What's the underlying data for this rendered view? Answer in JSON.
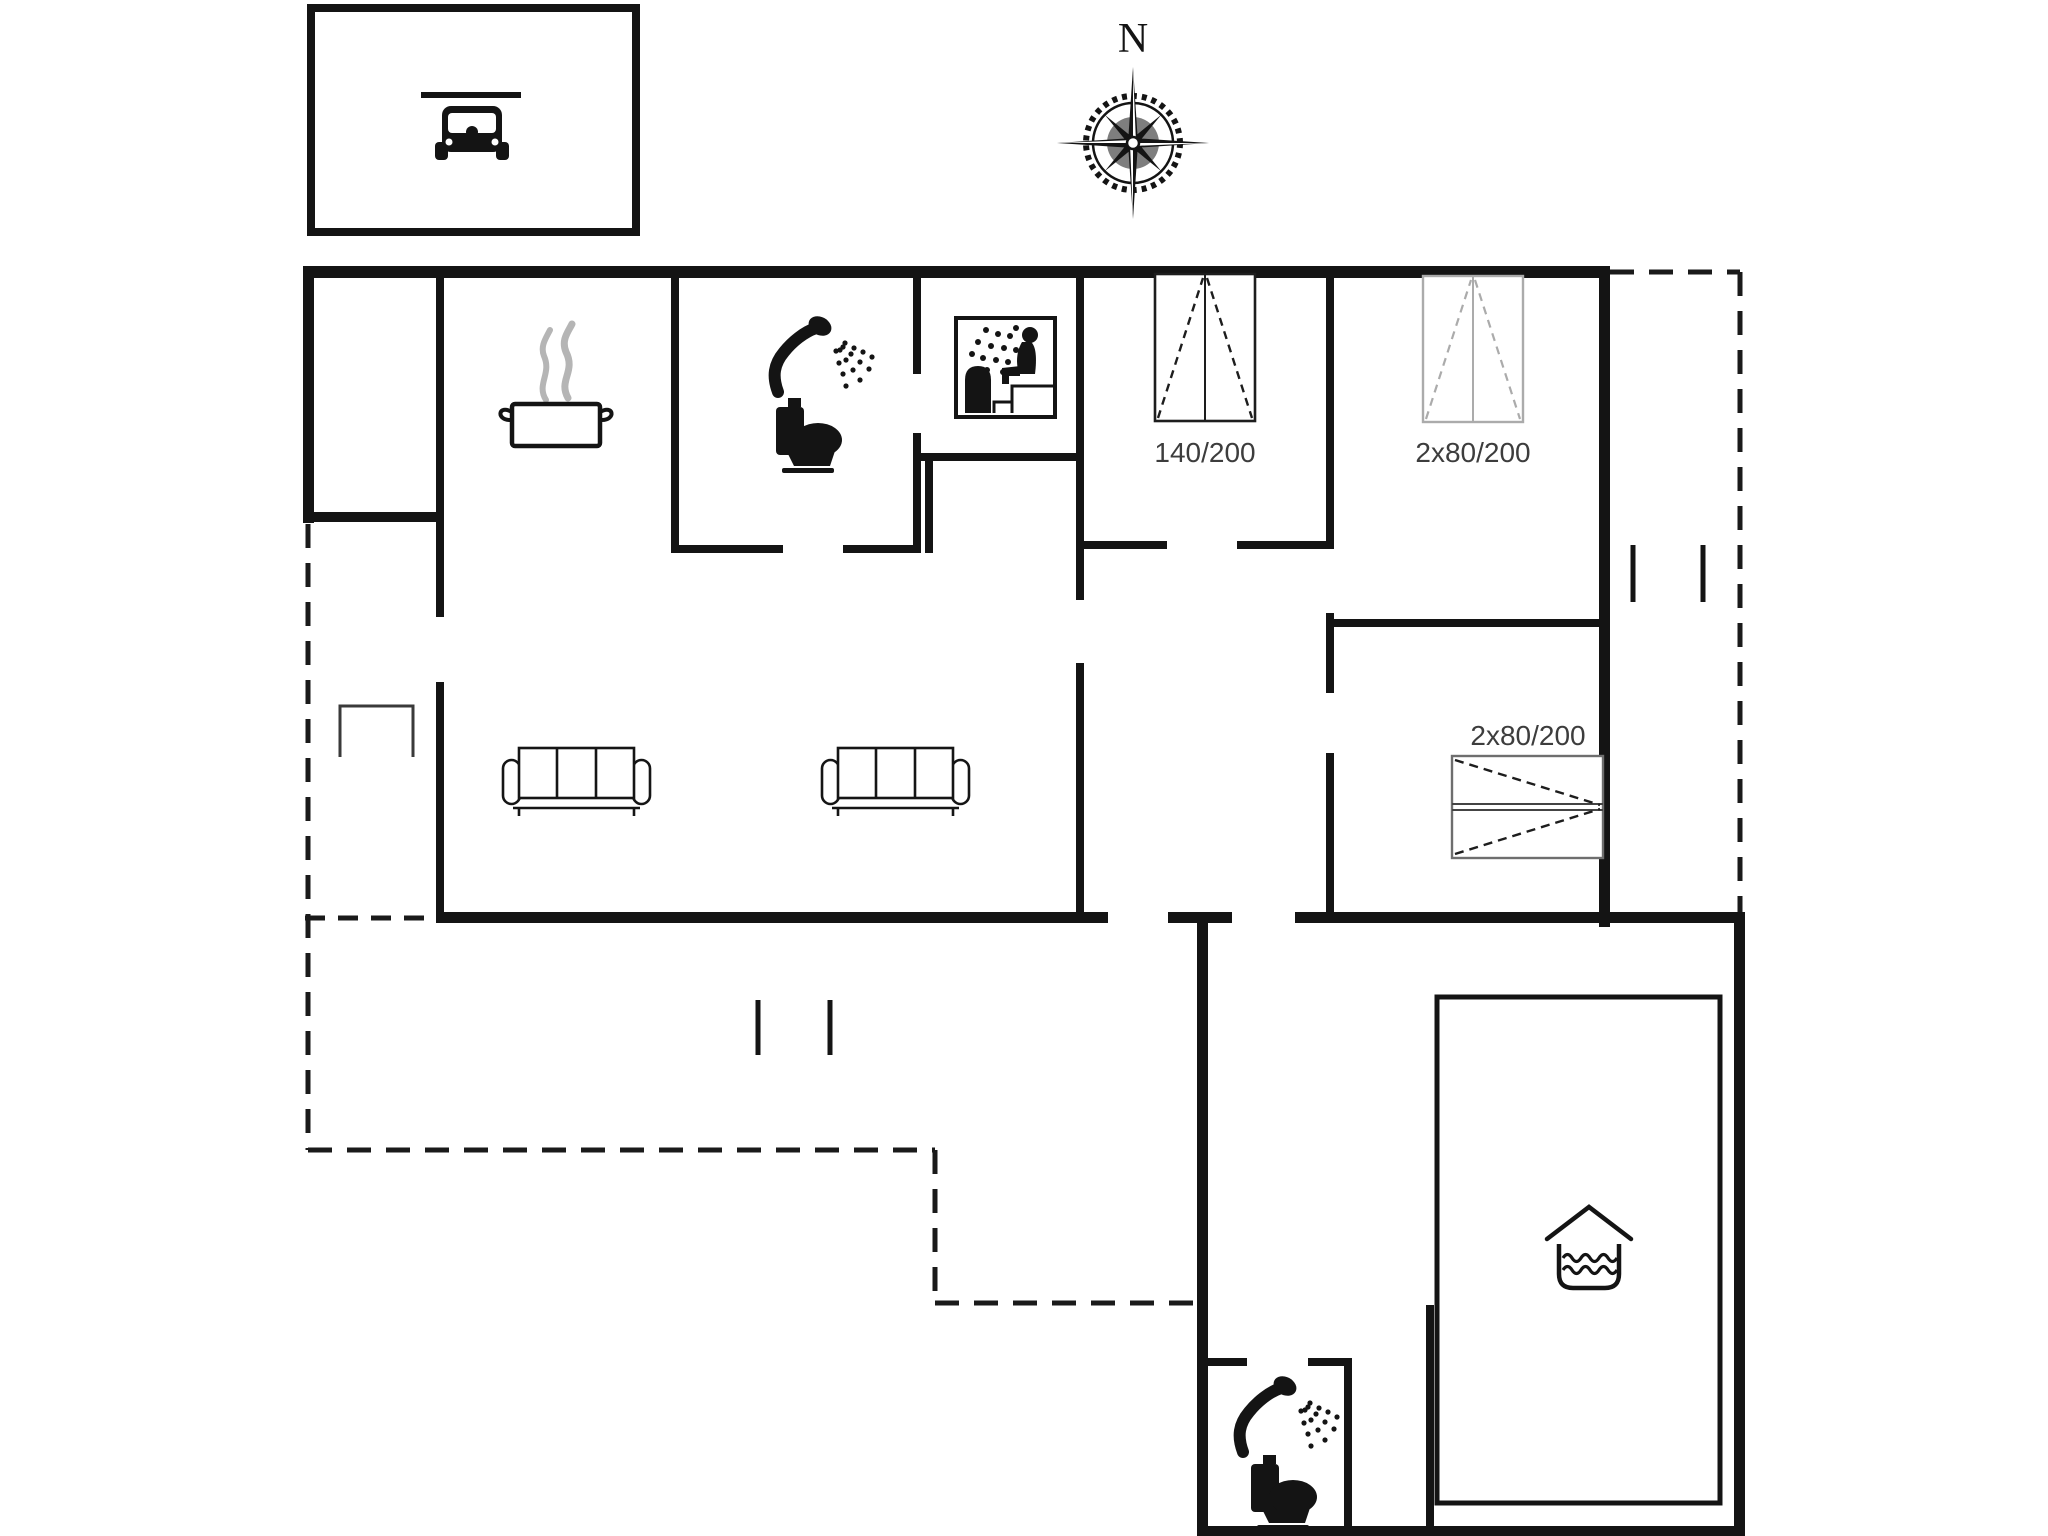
{
  "title": "Holiday house floor plan",
  "compass": {
    "label": "N"
  },
  "beds": {
    "double": {
      "label": "140/200"
    },
    "twin_top": {
      "label": "2x80/200"
    },
    "twin_right": {
      "label": "2x80/200"
    }
  },
  "colors": {
    "background": "#ffffff",
    "wall": "#141414",
    "gray_symbol": "#ababab",
    "label_text": "#3d3d3d",
    "steam": "#b5b5b5"
  },
  "icons": [
    "car-icon",
    "compass-rose-icon",
    "cooking-pot-icon",
    "steam-icon",
    "shower-icon",
    "toilet-icon",
    "sauna-icon",
    "sofa-icon",
    "bed-symbol-icon",
    "pool-icon",
    "terrace-opening-icon",
    "bench-icon"
  ]
}
